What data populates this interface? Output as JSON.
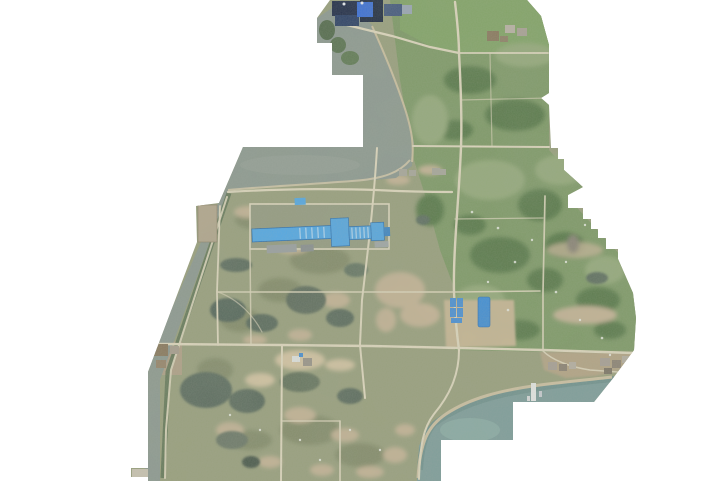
{
  "page": {
    "type": "aerial-orthophoto",
    "description": "Drone orthomosaic of a coastal land-survey area with an irregular white-masked boundary",
    "width_px": 723,
    "height_px": 481
  },
  "palette": {
    "bg": "#ffffff",
    "land_scrub": "#99a07e",
    "land_green": "#7f9a68",
    "field_light": "#95aa7c",
    "field_ne": "#83a468",
    "forest": "#5a7a4c",
    "olive_dark": "#858d6c",
    "water_band": "#8e9a91",
    "water_river": "#97a39a",
    "water_bay": "#7f9e9b",
    "water_shallow": "#8fb0aa",
    "water_deep": "#6f908c",
    "pond": "#5d6d5f",
    "pond_dark": "#4c5a4e",
    "road": "#ddd6bd",
    "shore_sand": "#ccc0a2",
    "bare_tan": "#c3b395",
    "bright_tan": "#d2c3a2",
    "construction_tan": "#c6b694",
    "yard_gray": "#959c82",
    "factory_blue": "#54a8e4",
    "factory_blue_edge": "#2d6fae",
    "factory_stripe": "#cfe4f4",
    "small_blue": "#3f8ed8",
    "navy_dark": "#232f4a",
    "navy_mid": "#2e4266",
    "navy_deep": "#1d2940",
    "bright_blue": "#3a6fd8",
    "steel_gray": "#44597e",
    "village_tan": "#b4a486",
    "roof_gray": "#a8a096",
    "roof_brown": "#8a7a5f",
    "pier_white": "#e6e8e6",
    "speck_white": "#e9ece4",
    "tree_dark": "#5f7456",
    "pad_gray": "#a8a79b"
  },
  "features": {
    "factory": "long blue-roofed factory complex in fenced yard",
    "aquaculture_yard": "cleared lot with blue tanks and liners",
    "industrial_plant": "dark-roofed plant at north edge",
    "village_dock": "shoreline village with pier and boats",
    "river": "river entering from the north",
    "bay": "tidal bay along the south-east shore",
    "ponds": "dark fish ponds in the south-west",
    "roads": "rural road grid and shore roads"
  }
}
